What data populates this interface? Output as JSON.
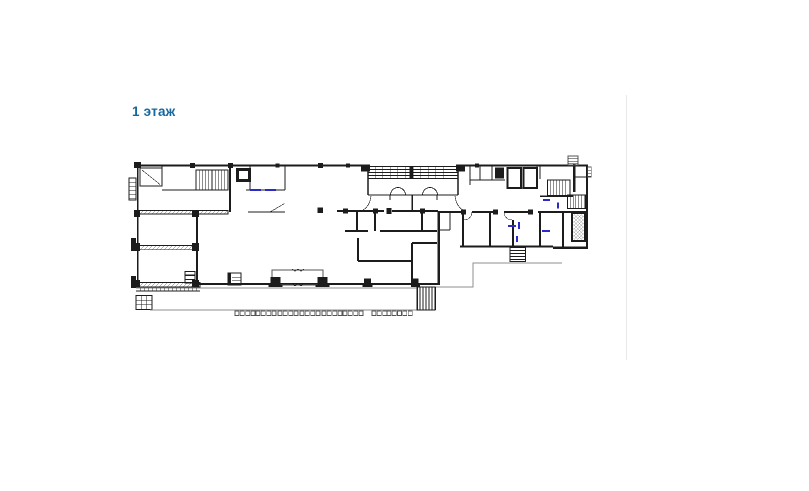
{
  "css_vars": {
    "--heading-color": "#15689e",
    "--divider-color": "#e9e9e9",
    "--wall": "#1c1c1c",
    "--wall2": "#555555",
    "--pave": "#8f8f8f",
    "--blue": "#2b2bc8"
  },
  "page": {
    "background": "#ffffff",
    "heading": {
      "text": "1 этаж",
      "color": "#15689e"
    },
    "divider": {
      "color": "#e9e9e9"
    }
  },
  "floorplan": {
    "kind": "architectural floor plan",
    "floor_label": "1 этаж",
    "wall_color": "#1c1c1c",
    "door_mark_color": "#2b2bc8",
    "features": [
      "building-outline",
      "left-bay-windows",
      "left-wing-rooms",
      "stairwell-top-left",
      "elevator-top-left",
      "glazed-terrace-top-center",
      "hall-columns",
      "entrance-porch-bottom-center",
      "storage-boxes-left",
      "kiosk",
      "mid-rooms",
      "right-wing-rooms",
      "stair-right-lower",
      "rooms-top-right",
      "elevator-block-top-right",
      "stair-top-right",
      "right-tower-stairs-and-shaft",
      "lower-terrace",
      "exterior-stair-south",
      "paver-ticks",
      "pavement-edge",
      "blue-door-marks"
    ]
  }
}
